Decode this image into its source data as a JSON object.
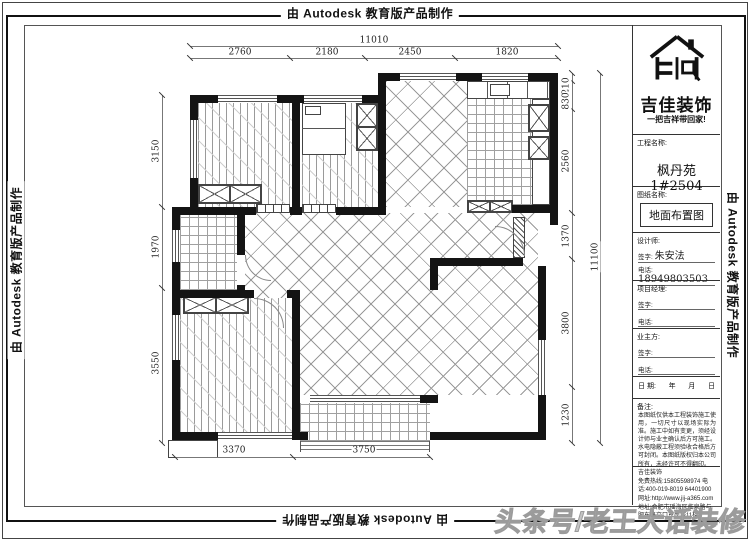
{
  "stamp": {
    "text": "由 Autodesk 教育版产品制作"
  },
  "watermark": "头条号/老王大话装修",
  "dimensions": {
    "top": {
      "overall": "11010",
      "segments": [
        "2760",
        "2180",
        "2450",
        "1820"
      ]
    },
    "left": [
      "3150",
      "1970",
      "3550"
    ],
    "right": {
      "overall": "11100",
      "segments": [
        "210",
        "830",
        "2560",
        "1370",
        "3800",
        "1230"
      ]
    },
    "bottom": [
      "3370",
      "3750"
    ]
  },
  "title_block": {
    "brand": "吉佳装饰",
    "slogan": "一把吉祥带回家!",
    "project_label": "工程名称:",
    "project_value": "枫丹苑1#2504",
    "sheet_label": "图纸名称:",
    "sheet_value": "地面布置图",
    "designer_label": "设计师:",
    "sign_label": "签字:",
    "phone_label": "电话:",
    "designer_name": "朱安法",
    "designer_phone": "18949803503",
    "pm_label": "项目经理:",
    "owner_label": "业主方:",
    "date_label": "日 期:",
    "date_year": "年",
    "date_month": "月",
    "date_day": "日",
    "notes_label": "备注:",
    "notes_text": "本图纸仅供本工程装饰施工使用，一切尺寸以现场实际为准。施工中如有变更，须经设计师与业主确认后方可施工。水电隐蔽工程须验收合格后方可封闭。本图纸版权归本公司所有，未经许可不得翻印。",
    "company": {
      "name": "吉佳装饰",
      "hotline": "免费热线:15805598974",
      "tel": "电 话:400-019-8019 64401900",
      "web": "网址:http://www.jij-a365.com",
      "addr": "地址:合肥市瑶海区临泉路与肥东路交口东岸城11楼"
    }
  }
}
